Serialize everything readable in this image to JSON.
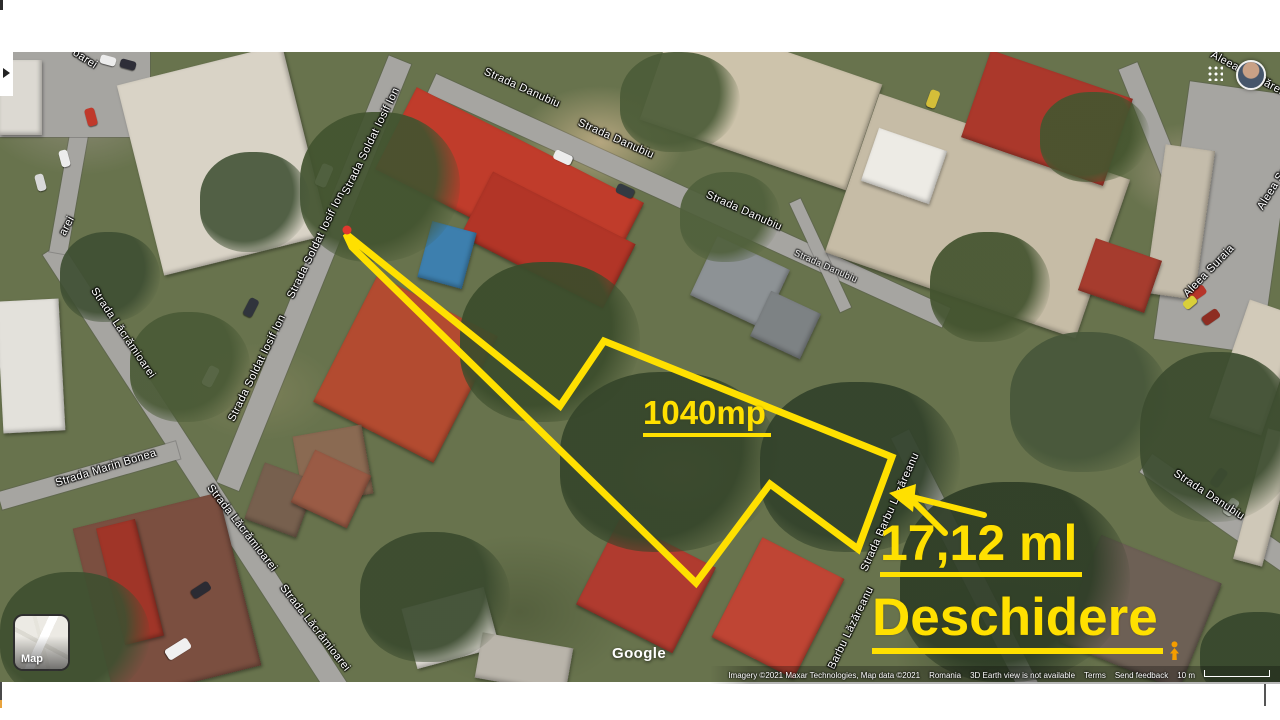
{
  "map_annotations": {
    "area_label": "1040mp",
    "frontage_label": "17,12 ml",
    "opening_label": "Deschidere",
    "accent_color": "#ffe000",
    "tip_marker_color": "#e0382e",
    "lot_outline_points": "346,182 560,354 604,289 892,405 858,497 770,432 696,531 352,195"
  },
  "street_labels": [
    {
      "text": "Strada Danubiu"
    },
    {
      "text": "Strada Danubiu"
    },
    {
      "text": "Strada Danubiu"
    },
    {
      "text": "Strada Danubiu"
    },
    {
      "text": "Strada Danubiu"
    },
    {
      "text": "Strada Soldat Iosif Ion"
    },
    {
      "text": "Strada Soldat Iosif Ion"
    },
    {
      "text": "Strada Soldat Iosif Ion"
    },
    {
      "text": "Strada Lăcrămioarei"
    },
    {
      "text": "Strada Lăcrămioarei"
    },
    {
      "text": "Strada Lăcrămioarei"
    },
    {
      "text": "arei"
    },
    {
      "text": "oarei"
    },
    {
      "text": "Strada Marin Bonea"
    },
    {
      "text": "Strada Barbu Lăzăreanu"
    },
    {
      "text": "Barbu Lăzăreanu"
    },
    {
      "text": "Aleea Suraia"
    },
    {
      "text": "Aleea Suraia"
    },
    {
      "text": "Aleea Țăndărei"
    }
  ],
  "controls": {
    "map_button_label": "Map"
  },
  "branding": {
    "google_logo": "Google"
  },
  "attribution": {
    "imagery_credit": "Imagery ©2021 Maxar Technologies, Map data ©2021",
    "region": "Romania",
    "notice": "3D Earth view is not available",
    "terms_label": "Terms",
    "feedback_label": "Send feedback",
    "scale_label": "10 m"
  }
}
